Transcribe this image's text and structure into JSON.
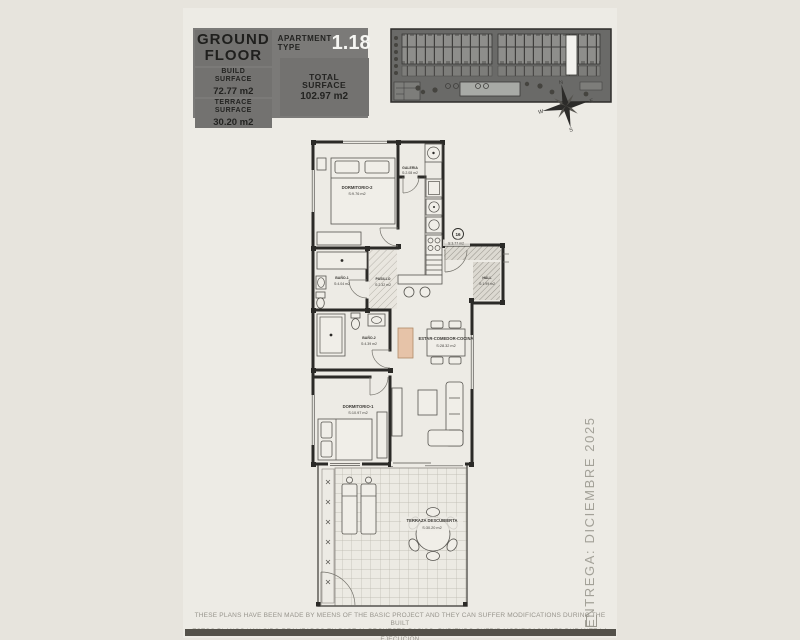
{
  "header": {
    "floor_title": "GROUND FLOOR",
    "apartment_type_label": "APARTMENT TYPE",
    "apartment_type_value": "1.18",
    "build": {
      "label": "BUILD SURFACE",
      "value": "72.77 m2"
    },
    "terrace": {
      "label": "TERRACE SURFACE",
      "value": "30.20 m2"
    },
    "total": {
      "label": "TOTAL SURFACE",
      "value": "102.97 m2"
    }
  },
  "site_plan": {
    "compass": {
      "n": "N",
      "e": "E",
      "s": "S",
      "w": "W"
    },
    "highlight_color": "#f3f2ee"
  },
  "floor_plan": {
    "unit_badge": "16",
    "entry_area": "S:3.77 m2",
    "rooms": {
      "dormitorio2": {
        "name": "DORMITORIO-2",
        "area": "S:9.76 m2"
      },
      "galeria": {
        "name": "GALERIA",
        "area": "S:2.08 m2"
      },
      "bano1": {
        "name": "BAÑO-1",
        "area": "S:4.04 m2"
      },
      "pasillo": {
        "name": "PASILLO",
        "area": "S:2.32 m2"
      },
      "hall": {
        "name": "HALL",
        "area": "S:1.99 m2"
      },
      "bano2": {
        "name": "BAÑO-2",
        "area": "S:4.39 m2"
      },
      "estar": {
        "name": "ESTAR-COMEDOR-COCINA",
        "area": "S:28.32 m2"
      },
      "dormitorio1": {
        "name": "DORMITORIO-1",
        "area": "S:10.97 m2"
      },
      "terraza": {
        "name": "TERRAZA DESCUBIERTA",
        "area": "S:30.20 m2"
      }
    }
  },
  "delivery_note": "ENTREGA: DICIEMBRE 2025",
  "footer": {
    "line1": "THESE PLANS HAVE BEEN MADE BY MEENS OF THE BASIC PROJECT AND THEY CAN SUFFER MODIFICATIONS DURING THE BUILT",
    "line2": "ESTOS PLANOS HAN SIDO REALIZADOS EN BASE AL PROYECTO BASICO, PUDIENDO SUFRIR MODIFICACIONES DURANTE LA EJECUCION"
  },
  "colors": {
    "page_bg": "#e7e4dd",
    "panel_gray": "#7b7a78",
    "site_gray": "#6a6a68",
    "wall_dark": "#2b2a27",
    "tan_accent": "#e6c3a8",
    "bottom_bar": "#54514a",
    "delivery_text": "#a3a198"
  }
}
